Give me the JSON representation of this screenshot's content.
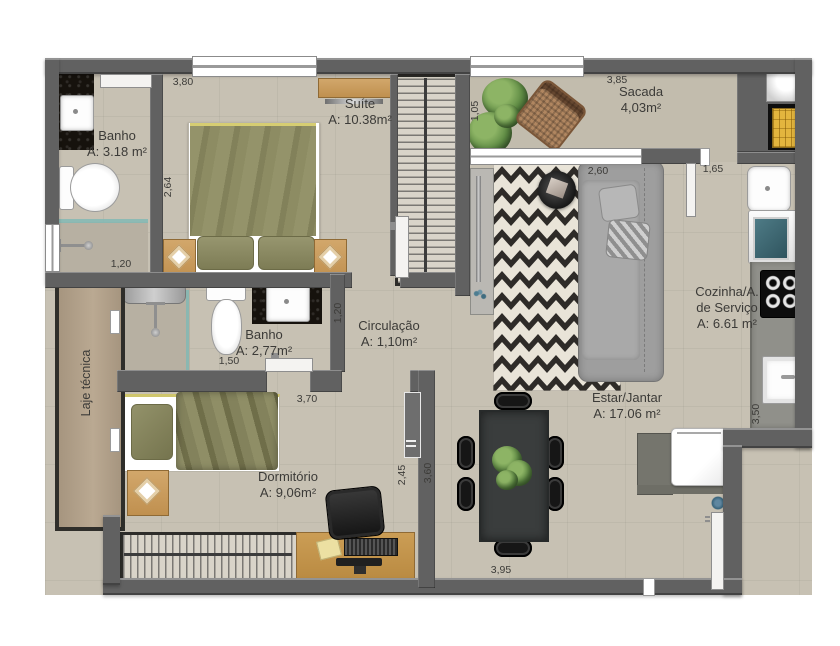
{
  "plan": {
    "rooms": {
      "banho_suite": {
        "name": "Banho",
        "area": "A: 3.18 m²"
      },
      "suite": {
        "name": "Suíte",
        "area": "A: 10.38m²"
      },
      "sacada": {
        "name": "Sacada",
        "area": "4,03m²"
      },
      "banho_social": {
        "name": "Banho",
        "area": "A: 2,77m²"
      },
      "circulacao": {
        "name": "Circulação",
        "area": "A: 1,10m²"
      },
      "cozinha_servico": {
        "name_line1": "Cozinha/A.",
        "name_line2": "de Serviço",
        "area": "A: 6.61 m²"
      },
      "estar_jantar": {
        "name": "Estar/Jantar",
        "area": "A: 17.06 m²"
      },
      "dormitorio": {
        "name": "Dormitório",
        "area": "A: 9,06m²"
      },
      "laje_tecnica": {
        "name": "Laje técnica"
      }
    },
    "dimensions": {
      "suite_width": "3,80",
      "suite_depth": "2,64",
      "banho_suite_width": "1,20",
      "sacada_width": "3,85",
      "sacada_depth": "1,05",
      "estar_window": "2,60",
      "sacada_passage": "1,65",
      "circulacao_width": "1,20",
      "banho_social_width": "1,50",
      "dormitorio_width": "3,70",
      "dormitorio_door": "2,45",
      "estar_depth": "3,60",
      "cozinha_depth": "3,50",
      "estar_width": "3,95"
    },
    "colors": {
      "wall": "#616161",
      "floor": "#c7c1b3",
      "olive": "#8f8e67",
      "rug_dark": "#2e2b28",
      "rug_light": "#e9e4d8",
      "wood": "#c49a5f",
      "washer_teal": "#3f6a75",
      "grill_yellow": "#e3b53e",
      "granite": "#16120d"
    }
  }
}
